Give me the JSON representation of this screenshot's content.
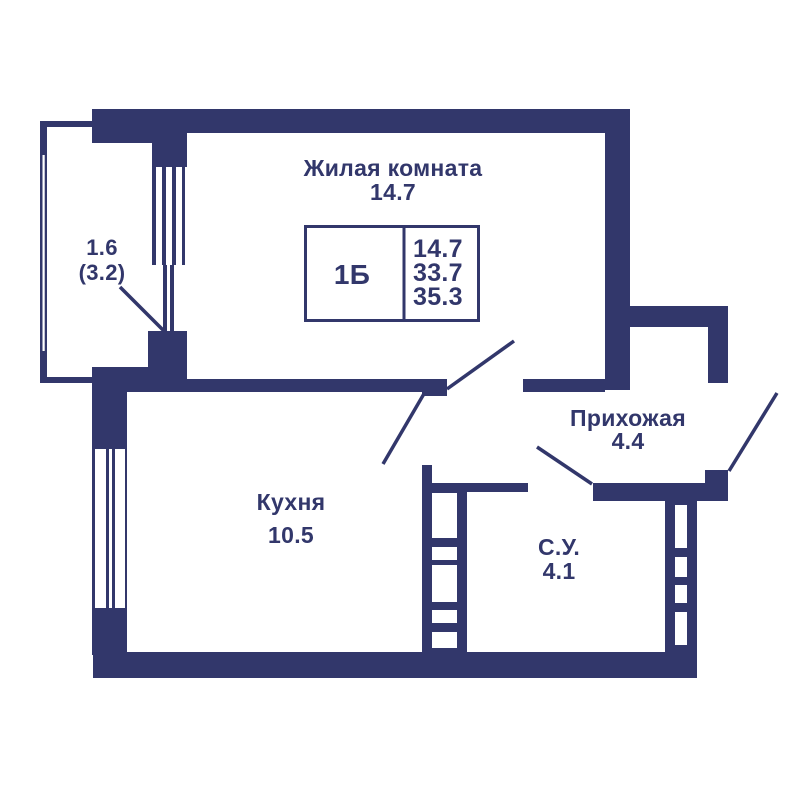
{
  "plan": {
    "living_room": {
      "label": "Жилая комната",
      "area": "14.7"
    },
    "kitchen": {
      "label": "Кухня",
      "area": "10.5"
    },
    "hallway": {
      "label": "Прихожая",
      "area": "4.4"
    },
    "bathroom": {
      "label": "С.У.",
      "area": "4.1"
    },
    "balcony": {
      "area": "1.6",
      "area_full": "(3.2)"
    },
    "info_box": {
      "unit_type": "1Б",
      "living_area": "14.7",
      "area_without_balcony": "33.7",
      "total_area": "35.3"
    },
    "colors": {
      "wall": "#32376B",
      "background": "#FFFFFF"
    }
  }
}
